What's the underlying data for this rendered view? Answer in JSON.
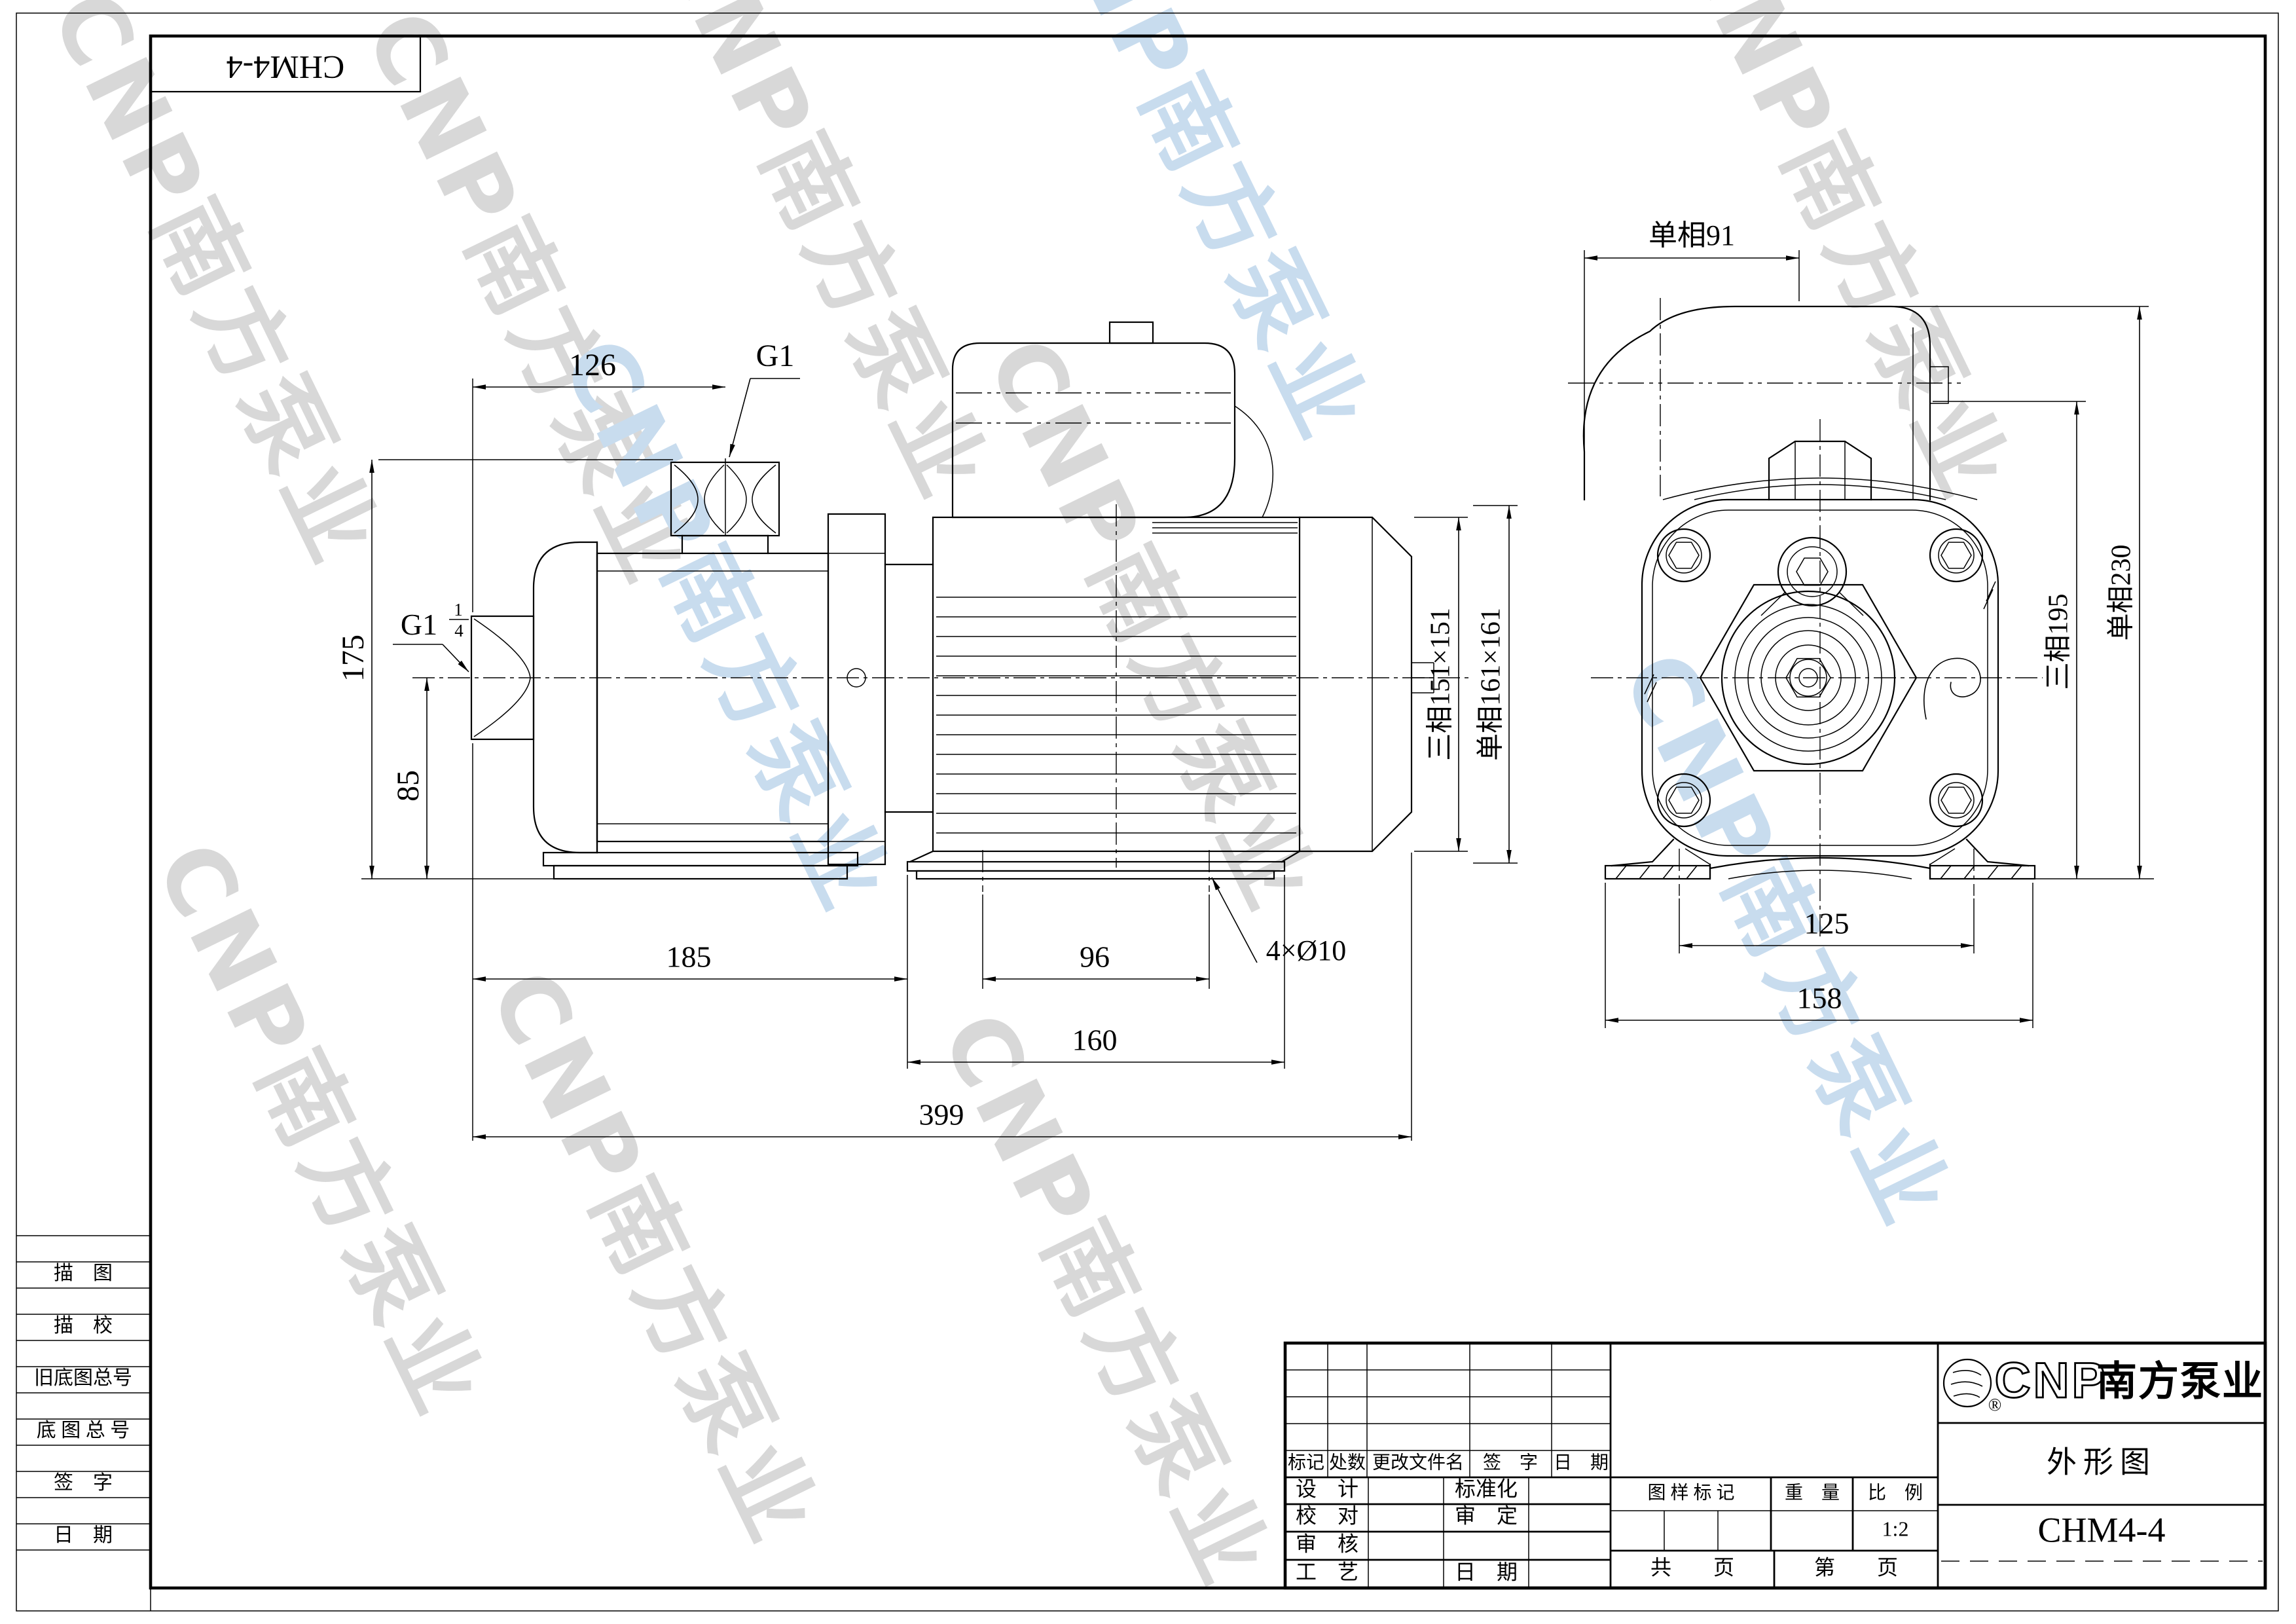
{
  "sheet": {
    "model_box": "CHM4-4",
    "watermark": "CNP南方泵业"
  },
  "side_view": {
    "d126": "126",
    "g1": "G1",
    "d175": "175",
    "d85": "85",
    "g1q_prefix": "G1",
    "g1q_num": "1",
    "g1q_den": "4",
    "d185": "185",
    "d96": "96",
    "holes": "4×Ø10",
    "d160": "160",
    "d399": "399",
    "sq_3ph": "三相151×151",
    "sq_1ph": "单相161×161"
  },
  "front_view": {
    "w_1ph": "单相91",
    "h_3ph": "三相195",
    "h_1ph": "单相230",
    "d125": "125",
    "d158": "158"
  },
  "sidebar": {
    "rows": [
      "描　图",
      "描　校",
      "旧底图总号",
      "底 图 总 号",
      "签　字",
      "日　期"
    ]
  },
  "title_block": {
    "rev_header": [
      "标记",
      "处数",
      "更改文件名",
      "签　字",
      "日　期"
    ],
    "left_labels": [
      "设　计",
      "校　对",
      "审　核",
      "工　艺"
    ],
    "right_labels": [
      "标准化",
      "审　定",
      "日　期"
    ],
    "stamp_labels": [
      "图 样 标 记",
      "重　量",
      "比　例"
    ],
    "scale": "1:2",
    "pages_total": "共　　页",
    "pages_no": "第　　页",
    "brand_cnp": "CNP",
    "brand_name": "南方泵业",
    "brand_reg": "®",
    "doc_type": "外形图",
    "model": "CHM4-4"
  }
}
